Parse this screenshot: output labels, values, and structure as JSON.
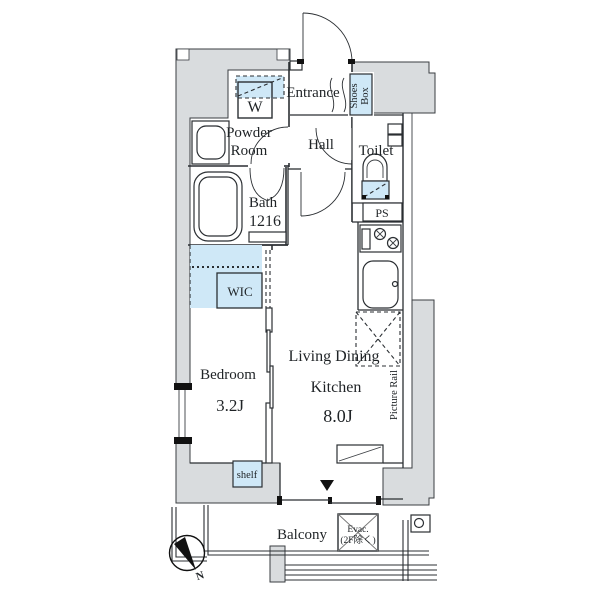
{
  "plan": {
    "type": "apartment-floorplan",
    "labels": {
      "entrance": "Entrance",
      "shoes_box_line1": "Shoes",
      "shoes_box_line2": "Box",
      "washer": "W",
      "powder_line1": "Powder",
      "powder_line2": "Room",
      "hall": "Hall",
      "toilet": "Toilet",
      "bath_line1": "Bath",
      "bath_line2": "1216",
      "ps": "PS",
      "wic": "WIC",
      "bedroom": "Bedroom",
      "bedroom_size": "3.2J",
      "ldk_line1": "Living Dining",
      "ldk_line2": "Kitchen",
      "ldk_size": "8.0J",
      "picture_rail": "Picture Rail",
      "shelf": "shelf",
      "balcony": "Balcony",
      "evac_line1": "Evac.",
      "evac_line2": "(2F除く)",
      "compass_north": "N"
    },
    "colors": {
      "wall_gray": "#d9dcde",
      "fixture_blue": "#cfe8f7",
      "line": "#2b2f33",
      "background": "#ffffff"
    }
  }
}
